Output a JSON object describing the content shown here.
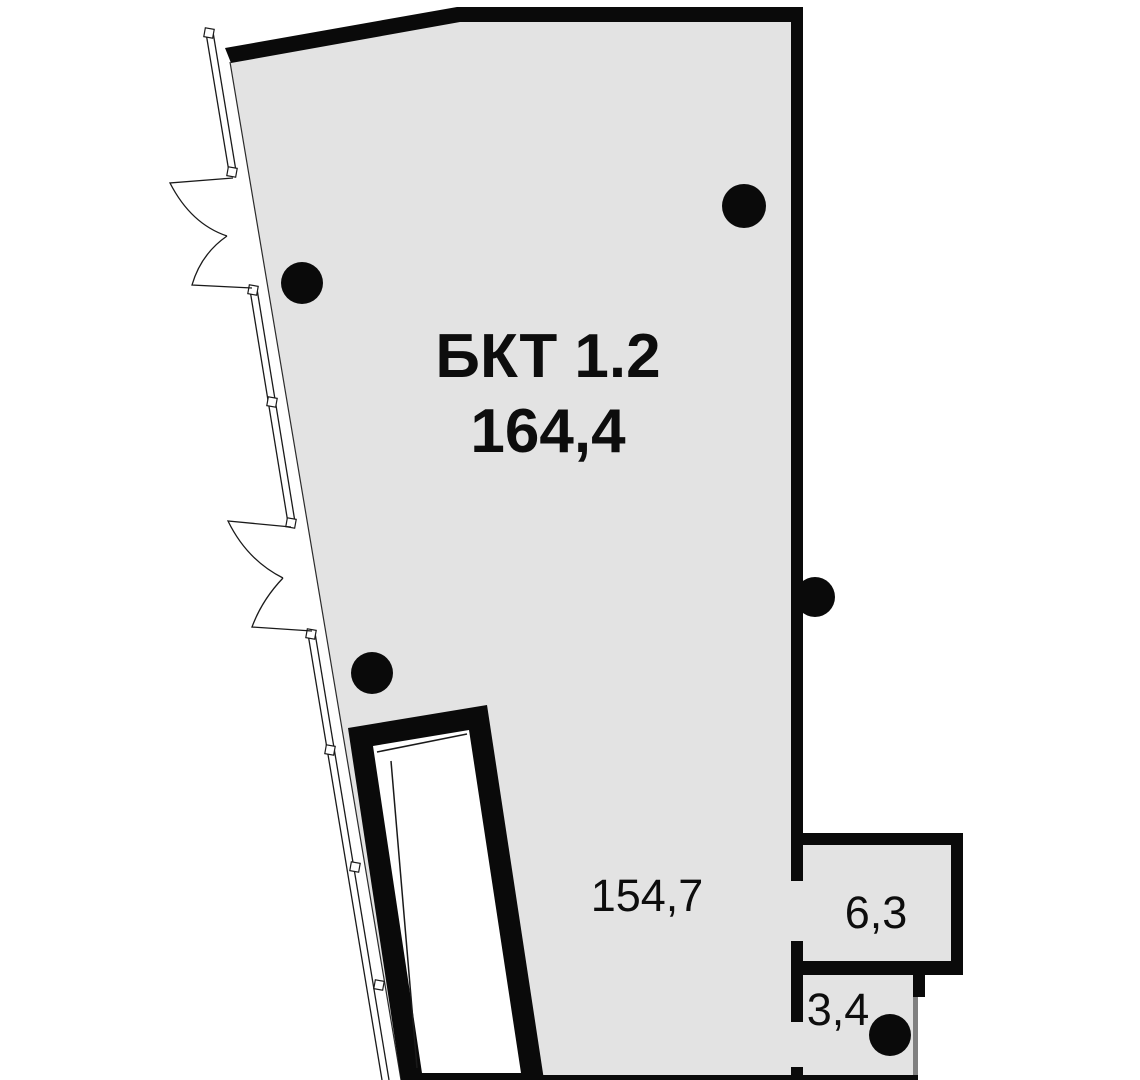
{
  "plan": {
    "type": "floor-plan",
    "colors": {
      "floor": "#e3e3e3",
      "wall": "#0a0a0a",
      "partition": "#808080",
      "background": "#ffffff",
      "label": "#0d0d0d"
    },
    "columns": [
      {
        "cx": 744,
        "cy": 206,
        "r": 22
      },
      {
        "cx": 302,
        "cy": 283,
        "r": 21
      },
      {
        "cx": 815,
        "cy": 597,
        "r": 20
      },
      {
        "cx": 372,
        "cy": 673,
        "r": 21
      },
      {
        "cx": 890,
        "cy": 1035,
        "r": 21
      }
    ]
  },
  "rooms": {
    "main": {
      "name": "БКТ 1.2",
      "area": "164,4"
    },
    "zone": {
      "area": "154,7"
    },
    "right": {
      "area": "6,3"
    },
    "bottom": {
      "area": "3,4"
    }
  }
}
